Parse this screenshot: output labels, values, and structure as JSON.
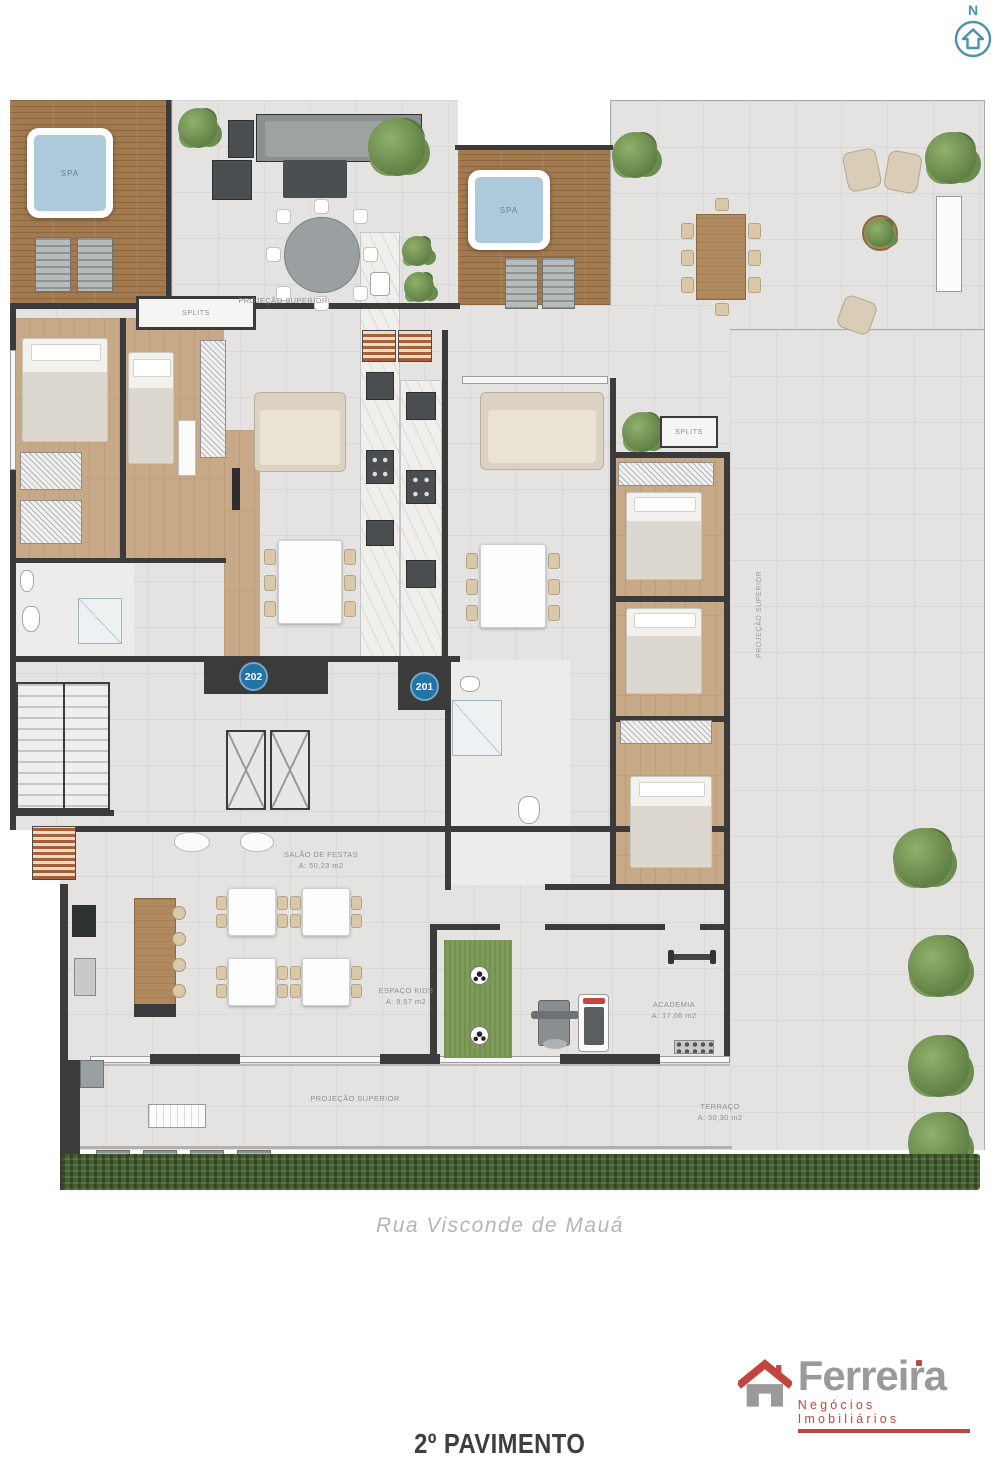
{
  "compass": {
    "letter": "N"
  },
  "plan": {
    "pools": {
      "spa_left": "SPA",
      "spa_right": "SPA"
    },
    "splits": {
      "left": "SPLITS",
      "right": "SPLITS"
    },
    "projections": {
      "top": "PROJEÇÃO SUPERIOR",
      "right": "PROJEÇÃO SUPERIOR",
      "bottom": "PROJEÇÃO SUPERIOR"
    },
    "units": {
      "left": "202",
      "right": "201"
    },
    "rooms": {
      "salao": {
        "name": "SALÃO DE FESTAS",
        "area": "A: 50,23 m2"
      },
      "kids": {
        "name": "ESPAÇO KIDS",
        "area": "A: 9,57 m2"
      },
      "academia": {
        "name": "ACADEMIA",
        "area": "A: 17,06 m2"
      },
      "terraco": {
        "name": "TERRAÇO",
        "area": "A: 50,30 m2"
      }
    }
  },
  "street": {
    "name": "Rua Visconde de Mauá"
  },
  "branding": {
    "company": "Ferreira",
    "tagline": "Negócios Imobiliários"
  },
  "floor_title": "2º PAVIMENTO",
  "colors": {
    "accent_teal": "#4a93a8",
    "badge_blue": "#2273a8",
    "wall_dark": "#3b3b3b",
    "wood_deck": "#a3794e",
    "wood_floor": "#c7a987",
    "tile_gray": "#e4e3e1",
    "pool_blue": "#adcadd",
    "lawn_green": "#7e9c57",
    "hedge_green": "#45602f",
    "logo_gray": "#9a9a9a",
    "logo_red": "#c2453e"
  }
}
